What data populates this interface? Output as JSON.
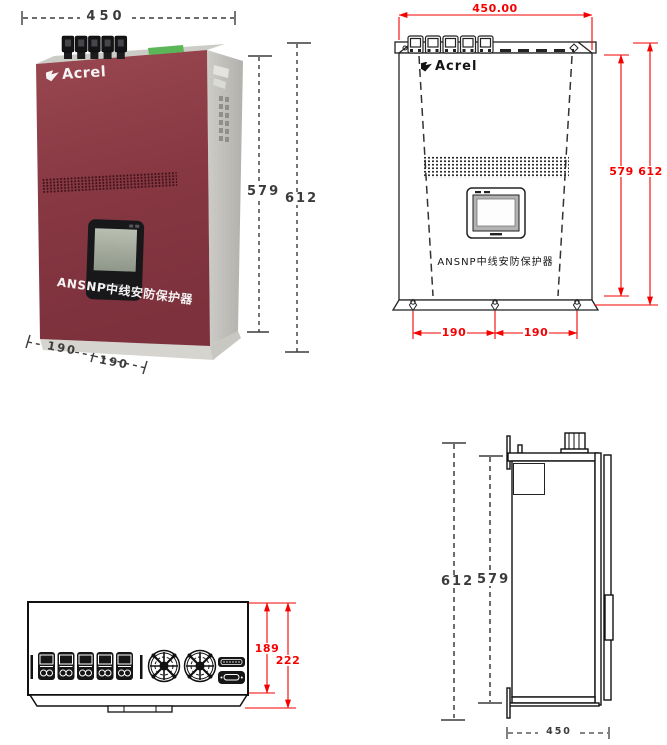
{
  "title": "ANSNP enclosure dimensional drawings",
  "colors": {
    "dimension_red": "#f40000",
    "dimension_dark": "#3b3b3b",
    "drawing_line": "#1a1a1a",
    "device_red": "#873842",
    "device_side_gray": "#c9c8c3",
    "label_green": "#5bb658",
    "screen_gray": "#a7afa0"
  },
  "views": {
    "photo": {
      "brand": "Acrel",
      "product_label": "ANSNP中线安防保护器",
      "dim_width": "450",
      "dim_height_front": "579",
      "dim_height_total": "612",
      "dim_hole_left": "190",
      "dim_hole_right": "190"
    },
    "front": {
      "brand": "Acrel",
      "product_label": "ANSNP中线安防保护器",
      "dim_width": "450.00",
      "dim_height_front": "579",
      "dim_height_total": "612",
      "dim_hole_left": "190",
      "dim_hole_right": "190"
    },
    "top": {
      "dim_depth_body": "189",
      "dim_depth_total": "222"
    },
    "side": {
      "dim_height_total": "612",
      "dim_height_front": "579",
      "dim_width": "450"
    }
  }
}
